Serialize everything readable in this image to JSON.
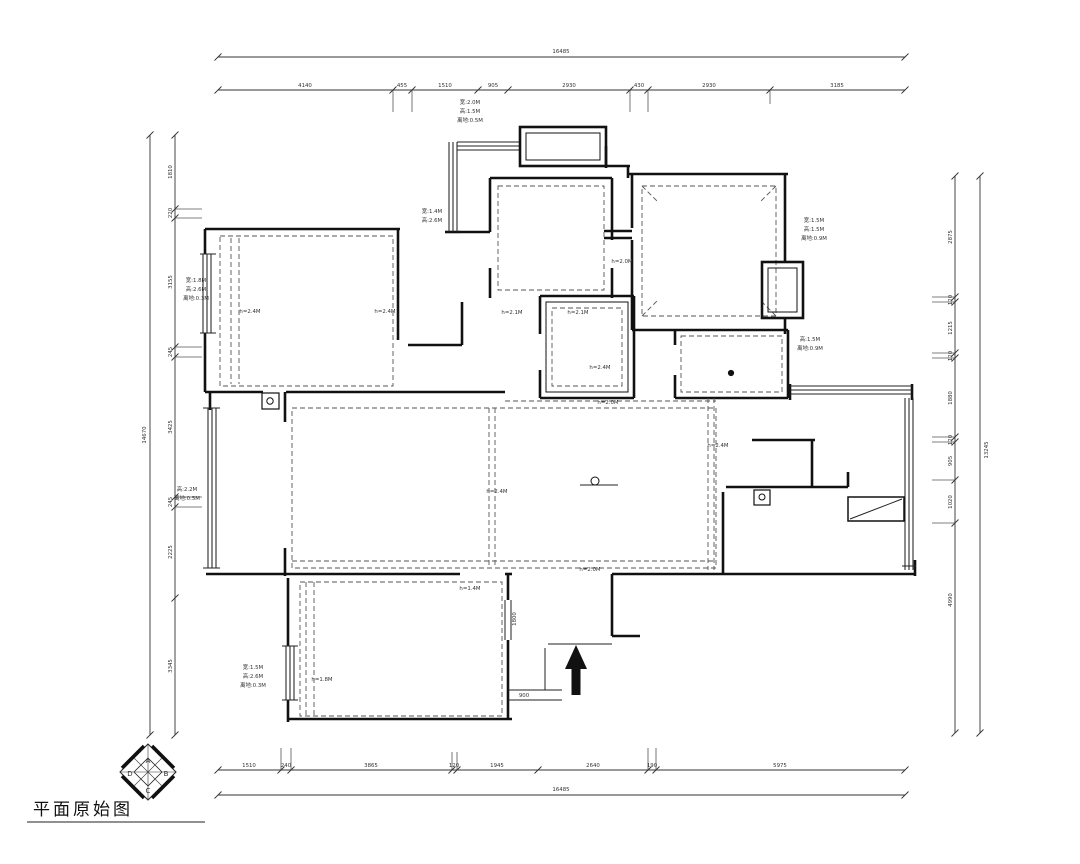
{
  "title_block": {
    "title": "平面原始图"
  },
  "compass": {
    "letters": [
      "A",
      "B",
      "C",
      "D"
    ]
  },
  "dimension_totals": {
    "top": "16485",
    "bottom": "16485",
    "left": "14670",
    "right": "13245"
  },
  "drawing": {
    "meta": {
      "width": 1080,
      "height": 864,
      "bg": "#ffffff"
    },
    "walls": [
      [
        205,
        229,
        400,
        229
      ],
      [
        205,
        229,
        205,
        254
      ],
      [
        205,
        333,
        205,
        392
      ],
      [
        205,
        392,
        263,
        392
      ],
      [
        286,
        392,
        505,
        392
      ],
      [
        398,
        229,
        398,
        340
      ],
      [
        408,
        345,
        462,
        345
      ],
      [
        462,
        302,
        462,
        345
      ],
      [
        461,
        232,
        490,
        232
      ],
      [
        490,
        178,
        612,
        178
      ],
      [
        490,
        178,
        490,
        232
      ],
      [
        490,
        268,
        490,
        298
      ],
      [
        612,
        178,
        612,
        240
      ],
      [
        612,
        268,
        612,
        298
      ],
      [
        604,
        231,
        632,
        231
      ],
      [
        604,
        238,
        632,
        238
      ],
      [
        632,
        174,
        632,
        228
      ],
      [
        632,
        240,
        632,
        330
      ],
      [
        628,
        174,
        788,
        174
      ],
      [
        785,
        174,
        785,
        262
      ],
      [
        785,
        318,
        785,
        334
      ],
      [
        632,
        330,
        788,
        330
      ],
      [
        675,
        330,
        675,
        345
      ],
      [
        675,
        375,
        675,
        398
      ],
      [
        788,
        330,
        788,
        398
      ],
      [
        675,
        398,
        788,
        398
      ],
      [
        540,
        296,
        634,
        296
      ],
      [
        540,
        296,
        540,
        334
      ],
      [
        540,
        370,
        540,
        398
      ],
      [
        634,
        296,
        634,
        398
      ],
      [
        540,
        398,
        634,
        398
      ],
      [
        285,
        392,
        285,
        422
      ],
      [
        285,
        548,
        285,
        576
      ],
      [
        206,
        574,
        460,
        574
      ],
      [
        505,
        574,
        512,
        574
      ],
      [
        612,
        574,
        915,
        574
      ],
      [
        210,
        392,
        210,
        410
      ],
      [
        288,
        578,
        288,
        646
      ],
      [
        288,
        700,
        288,
        722
      ],
      [
        288,
        719,
        512,
        719
      ],
      [
        508,
        574,
        508,
        600
      ],
      [
        508,
        640,
        508,
        719
      ],
      [
        612,
        574,
        612,
        636
      ],
      [
        612,
        636,
        640,
        636
      ],
      [
        790,
        384,
        790,
        400
      ],
      [
        912,
        384,
        912,
        400
      ],
      [
        752,
        440,
        815,
        440
      ],
      [
        812,
        440,
        812,
        487
      ],
      [
        726,
        487,
        848,
        487
      ],
      [
        848,
        472,
        848,
        487
      ],
      [
        723,
        492,
        723,
        574
      ],
      [
        606,
        146,
        606,
        168
      ],
      [
        606,
        166,
        630,
        166
      ],
      [
        628,
        166,
        628,
        178
      ],
      [
        445,
        232,
        461,
        232
      ],
      [
        915,
        560,
        915,
        576
      ]
    ],
    "thin": [
      [
        200,
        254,
        216,
        254
      ],
      [
        200,
        333,
        216,
        333
      ],
      [
        203,
        408,
        220,
        408
      ],
      [
        203,
        568,
        220,
        568
      ],
      [
        282,
        646,
        298,
        646
      ],
      [
        282,
        700,
        298,
        700
      ],
      [
        505,
        600,
        505,
        640
      ],
      [
        511,
        600,
        511,
        640
      ],
      [
        548,
        644,
        612,
        644
      ],
      [
        508,
        690,
        562,
        690
      ],
      [
        508,
        700,
        562,
        700
      ],
      [
        545,
        648,
        545,
        690
      ],
      [
        850,
        519,
        902,
        499
      ],
      [
        580,
        485,
        618,
        485
      ],
      [
        27,
        822,
        205,
        822
      ],
      [
        902,
        566,
        916,
        566
      ]
    ],
    "windows": [
      [
        203,
        254,
        203,
        333
      ],
      [
        207,
        254,
        207,
        333
      ],
      [
        211,
        254,
        211,
        333
      ],
      [
        208,
        408,
        208,
        568
      ],
      [
        212,
        408,
        212,
        568
      ],
      [
        216,
        408,
        216,
        568
      ],
      [
        286,
        646,
        286,
        700
      ],
      [
        290,
        646,
        290,
        700
      ],
      [
        294,
        646,
        294,
        700
      ],
      [
        449,
        142,
        449,
        232
      ],
      [
        453,
        142,
        453,
        232
      ],
      [
        457,
        142,
        457,
        232
      ],
      [
        457,
        142,
        520,
        142
      ],
      [
        457,
        146,
        520,
        146
      ],
      [
        457,
        150,
        520,
        150
      ],
      [
        790,
        386,
        912,
        386
      ],
      [
        790,
        390,
        912,
        390
      ],
      [
        790,
        394,
        912,
        394
      ],
      [
        905,
        398,
        905,
        570
      ],
      [
        909,
        398,
        909,
        570
      ],
      [
        913,
        398,
        913,
        570
      ]
    ],
    "witness": [
      [
        393,
        90,
        393,
        112
      ],
      [
        412,
        90,
        412,
        112
      ],
      [
        630,
        90,
        630,
        112
      ],
      [
        648,
        90,
        648,
        112
      ],
      [
        770,
        90,
        770,
        104
      ],
      [
        281,
        748,
        281,
        770
      ],
      [
        291,
        748,
        291,
        770
      ],
      [
        452,
        752,
        452,
        770
      ],
      [
        457,
        752,
        457,
        770
      ],
      [
        648,
        748,
        648,
        770
      ],
      [
        656,
        748,
        656,
        770
      ],
      [
        175,
        209,
        202,
        209
      ],
      [
        175,
        218,
        202,
        218
      ],
      [
        175,
        347,
        202,
        347
      ],
      [
        175,
        357,
        202,
        357
      ],
      [
        175,
        497,
        202,
        497
      ],
      [
        175,
        507,
        202,
        507
      ],
      [
        932,
        297,
        955,
        297
      ],
      [
        932,
        302,
        955,
        302
      ],
      [
        932,
        353,
        955,
        353
      ],
      [
        932,
        358,
        955,
        358
      ],
      [
        932,
        437,
        955,
        437
      ],
      [
        932,
        442,
        955,
        442
      ],
      [
        932,
        480,
        955,
        480
      ],
      [
        932,
        523,
        955,
        523
      ]
    ],
    "dashes": [
      [
        231,
        238,
        231,
        384
      ],
      [
        239,
        238,
        239,
        384
      ],
      [
        489,
        408,
        489,
        568
      ],
      [
        495,
        408,
        495,
        568
      ],
      [
        292,
        561,
        716,
        561
      ],
      [
        708,
        398,
        708,
        570
      ],
      [
        714,
        398,
        714,
        570
      ],
      [
        306,
        582,
        306,
        716
      ],
      [
        314,
        582,
        314,
        716
      ],
      [
        505,
        401,
        716,
        401
      ],
      [
        642,
        186,
        658,
        202
      ],
      [
        776,
        186,
        760,
        202
      ],
      [
        642,
        316,
        658,
        300
      ],
      [
        776,
        316,
        760,
        300
      ]
    ],
    "dash_rects": [
      [
        220,
        236,
        173,
        150
      ],
      [
        498,
        186,
        106,
        104
      ],
      [
        642,
        186,
        134,
        130
      ],
      [
        552,
        308,
        70,
        78
      ],
      [
        681,
        336,
        101,
        56
      ],
      [
        292,
        408,
        424,
        160
      ],
      [
        300,
        582,
        202,
        134
      ]
    ],
    "rects": [
      [
        520,
        127,
        86,
        39,
        2.6
      ],
      [
        526,
        133,
        74,
        27,
        1
      ],
      [
        762,
        262,
        41,
        56,
        2.6
      ],
      [
        768,
        268,
        29,
        44,
        1
      ],
      [
        546,
        302,
        82,
        90,
        1
      ],
      [
        262,
        393,
        17,
        16,
        1.2
      ],
      [
        754,
        490,
        16,
        15,
        1.2
      ],
      [
        848,
        497,
        56,
        24,
        1.5
      ]
    ],
    "circles": [
      [
        270,
        401,
        3.2,
        0
      ],
      [
        762,
        497,
        3,
        0
      ],
      [
        731,
        373,
        2.6,
        1
      ],
      [
        595,
        481,
        4,
        0
      ]
    ],
    "polys": [
      {
        "n": "entry-arrow",
        "pts": "576,645 565,669 571.5,669 571.5,695 580.5,695 580.5,669 587,669",
        "fill": "#111",
        "sw": 0
      },
      {
        "n": "compass-outer-diamond",
        "pts": "148,744 176,772 148,800 120,772",
        "fill": "none",
        "sw": 1
      },
      {
        "n": "compass-inner-diamond",
        "pts": "148,758 162,772 148,786 134,772",
        "fill": "none",
        "sw": 0.8
      }
    ],
    "bold_edges": [
      [
        152,
        746,
        174,
        768
      ],
      [
        174,
        776,
        152,
        798
      ],
      [
        144,
        798,
        122,
        776
      ],
      [
        122,
        768,
        144,
        746
      ]
    ],
    "cross": [
      [
        148,
        744,
        148,
        800
      ],
      [
        120,
        772,
        176,
        772
      ],
      [
        134,
        758,
        162,
        786
      ],
      [
        162,
        758,
        134,
        786
      ]
    ],
    "texts": [
      {
        "x": 470,
        "y": 104,
        "t": "宽:2.0M"
      },
      {
        "x": 470,
        "y": 113,
        "t": "高:1.5M"
      },
      {
        "x": 470,
        "y": 122,
        "t": "离地:0.5M"
      },
      {
        "x": 432,
        "y": 213,
        "t": "宽:1.4M"
      },
      {
        "x": 432,
        "y": 222,
        "t": "高:2.6M"
      },
      {
        "x": 814,
        "y": 222,
        "t": "宽:1.5M"
      },
      {
        "x": 814,
        "y": 231,
        "t": "高:1.5M"
      },
      {
        "x": 814,
        "y": 240,
        "t": "离地:0.9M"
      },
      {
        "x": 810,
        "y": 341,
        "t": "高:1.5M"
      },
      {
        "x": 810,
        "y": 350,
        "t": "离地:0.9M"
      },
      {
        "x": 196,
        "y": 282,
        "t": "宽:1.8M"
      },
      {
        "x": 196,
        "y": 291,
        "t": "高:2.6M"
      },
      {
        "x": 196,
        "y": 300,
        "t": "离地:0.3M"
      },
      {
        "x": 187,
        "y": 491,
        "t": "高:2.2M"
      },
      {
        "x": 187,
        "y": 500,
        "t": "离地:0.5M"
      },
      {
        "x": 253,
        "y": 669,
        "t": "宽:1.5M"
      },
      {
        "x": 253,
        "y": 678,
        "t": "高:2.6M"
      },
      {
        "x": 253,
        "y": 687,
        "t": "离地:0.3M"
      },
      {
        "x": 250,
        "y": 313,
        "t": "h=2.4M"
      },
      {
        "x": 385,
        "y": 313,
        "t": "h=2.4M"
      },
      {
        "x": 512,
        "y": 314,
        "t": "h=2.1M"
      },
      {
        "x": 578,
        "y": 314,
        "t": "h=2.1M"
      },
      {
        "x": 600,
        "y": 369,
        "t": "h=2.4M"
      },
      {
        "x": 608,
        "y": 404,
        "t": "h=2.0M"
      },
      {
        "x": 622,
        "y": 263,
        "t": "h=2.0M"
      },
      {
        "x": 497,
        "y": 493,
        "t": "h=2.4M"
      },
      {
        "x": 718,
        "y": 447,
        "t": "h=2.4M"
      },
      {
        "x": 322,
        "y": 681,
        "t": "h=1.8M"
      },
      {
        "x": 470,
        "y": 590,
        "t": "h=1.4M"
      },
      {
        "x": 590,
        "y": 571,
        "t": "h=2.0M"
      },
      {
        "x": 516,
        "y": 619,
        "t": "1800",
        "r": -90
      },
      {
        "x": 524,
        "y": 697,
        "t": "900"
      },
      {
        "x": 148,
        "y": 763,
        "t": "A",
        "s": 7
      },
      {
        "x": 166,
        "y": 776,
        "t": "B",
        "s": 7
      },
      {
        "x": 148,
        "y": 793,
        "t": "C",
        "s": 7
      },
      {
        "x": 130,
        "y": 776,
        "t": "D",
        "s": 7
      }
    ],
    "dims": [
      {
        "o": "h",
        "pos": 57,
        "from": 218,
        "to": 905,
        "b": [
          218,
          905
        ],
        "off": -4,
        "labels": [
          {
            "t": "16485",
            "at": 561
          }
        ]
      },
      {
        "o": "h",
        "pos": 90,
        "from": 218,
        "to": 905,
        "b": [
          218,
          393,
          412,
          478,
          508,
          630,
          648,
          770,
          905
        ],
        "off": -3,
        "labels": [
          {
            "t": "4140",
            "at": 305
          },
          {
            "t": "455",
            "at": 402
          },
          {
            "t": "1510",
            "at": 445
          },
          {
            "t": "905",
            "at": 493
          },
          {
            "t": "2930",
            "at": 569
          },
          {
            "t": "430",
            "at": 639
          },
          {
            "t": "2930",
            "at": 709
          },
          {
            "t": "3185",
            "at": 837
          }
        ]
      },
      {
        "o": "h",
        "pos": 770,
        "from": 218,
        "to": 905,
        "b": [
          218,
          281,
          291,
          452,
          457,
          538,
          648,
          656,
          905
        ],
        "off": -3,
        "labels": [
          {
            "t": "1510",
            "at": 249
          },
          {
            "t": "240",
            "at": 286
          },
          {
            "t": "3865",
            "at": 371
          },
          {
            "t": "120",
            "at": 454
          },
          {
            "t": "1945",
            "at": 497
          },
          {
            "t": "2640",
            "at": 593
          },
          {
            "t": "190",
            "at": 652
          },
          {
            "t": "5975",
            "at": 780
          }
        ]
      },
      {
        "o": "h",
        "pos": 795,
        "from": 218,
        "to": 905,
        "b": [
          218,
          905
        ],
        "off": -4,
        "labels": [
          {
            "t": "16485",
            "at": 561
          }
        ]
      },
      {
        "o": "v",
        "pos": 150,
        "from": 135,
        "to": 735,
        "b": [
          135,
          735
        ],
        "off": -4,
        "labels": [
          {
            "t": "14670",
            "at": 435
          }
        ]
      },
      {
        "o": "v",
        "pos": 175,
        "from": 135,
        "to": 735,
        "b": [
          135,
          209,
          218,
          347,
          357,
          497,
          507,
          598,
          735
        ],
        "off": -3,
        "labels": [
          {
            "t": "1810",
            "at": 172
          },
          {
            "t": "220",
            "at": 213
          },
          {
            "t": "3155",
            "at": 282
          },
          {
            "t": "245",
            "at": 352
          },
          {
            "t": "3425",
            "at": 427
          },
          {
            "t": "245",
            "at": 502
          },
          {
            "t": "2225",
            "at": 552
          },
          {
            "t": "3345",
            "at": 666
          }
        ]
      },
      {
        "o": "v",
        "pos": 980,
        "from": 176,
        "to": 733,
        "b": [
          176,
          733
        ],
        "off": 8,
        "labels": [
          {
            "t": "13245",
            "at": 450
          }
        ]
      },
      {
        "o": "v",
        "pos": 955,
        "from": 176,
        "to": 733,
        "b": [
          176,
          297,
          302,
          353,
          358,
          437,
          442,
          480,
          523,
          733
        ],
        "off": -3,
        "labels": [
          {
            "t": "2875",
            "at": 237
          },
          {
            "t": "120",
            "at": 300
          },
          {
            "t": "1215",
            "at": 328
          },
          {
            "t": "120",
            "at": 356
          },
          {
            "t": "1880",
            "at": 398
          },
          {
            "t": "120",
            "at": 440
          },
          {
            "t": "905",
            "at": 461
          },
          {
            "t": "1020",
            "at": 502
          },
          {
            "t": "4990",
            "at": 600
          }
        ]
      }
    ]
  }
}
